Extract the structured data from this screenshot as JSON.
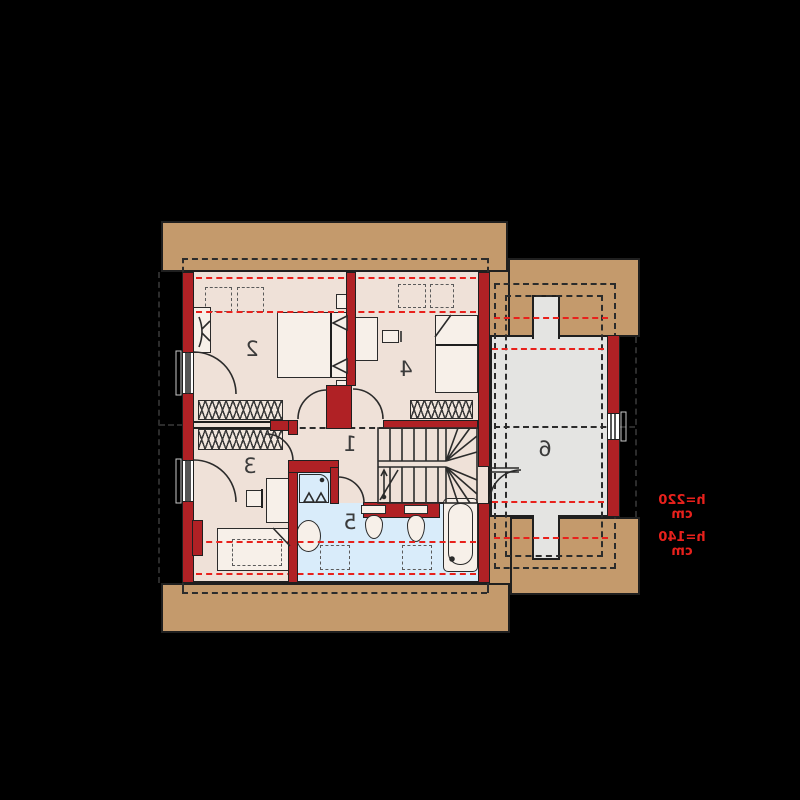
{
  "plan": {
    "type": "floor-plan",
    "rooms": [
      {
        "label": "1"
      },
      {
        "label": "2"
      },
      {
        "label": "3"
      },
      {
        "label": "4"
      },
      {
        "label": "5"
      },
      {
        "label": "6"
      }
    ],
    "annotations": [
      {
        "label": "h=220 cm"
      },
      {
        "label": "h=140 cm"
      }
    ],
    "colors": {
      "background": "#000000",
      "roof_band": "#c49a6c",
      "wall": "#b02125",
      "floor": "#efe1d8",
      "bathroom_floor": "#d9ecfa",
      "storage_floor": "#e4e4e2",
      "height_line": "#e8211c",
      "outline": "#1f1f1f"
    }
  }
}
